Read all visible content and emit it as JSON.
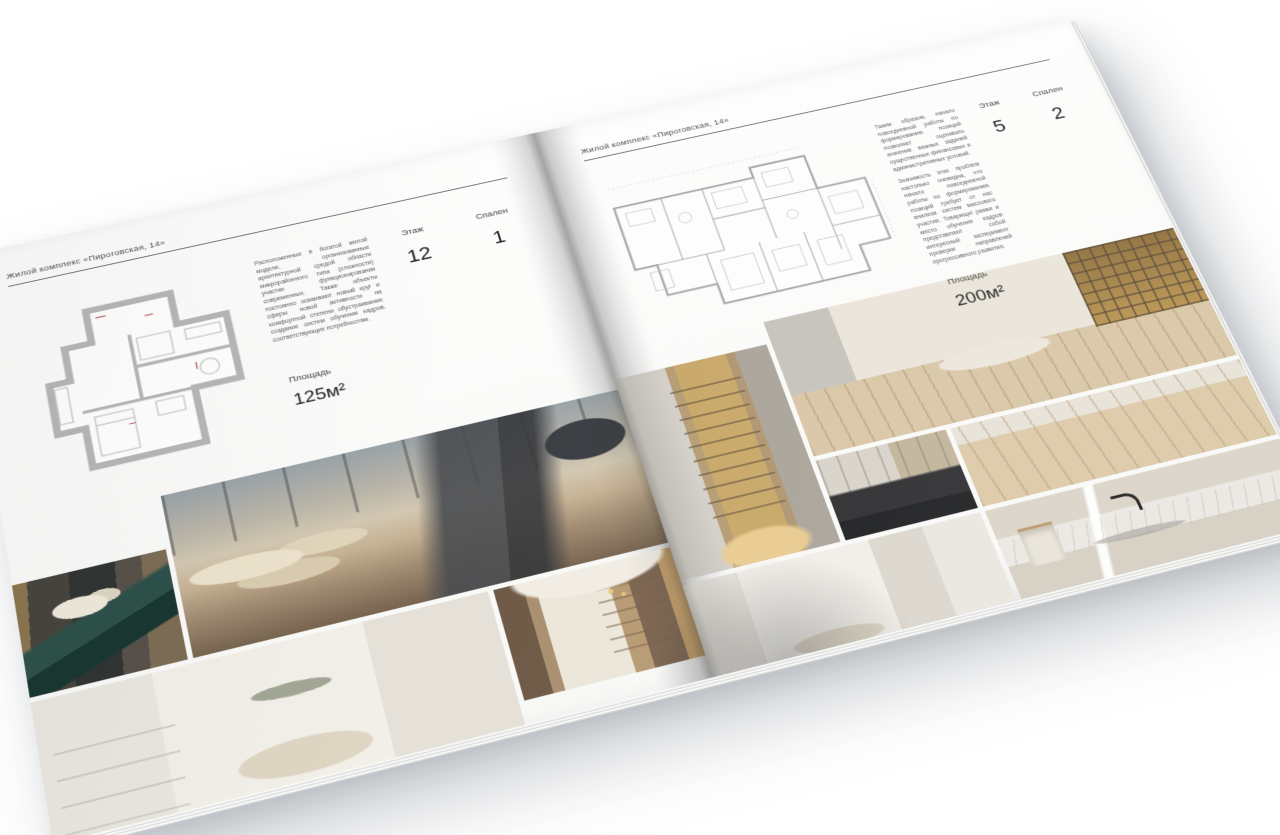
{
  "brochure": {
    "left_page": {
      "header": "Жилой комплекс «Пироговская, 14»",
      "description": "Расположенные в богатой жилой модели, организованные архитектурной средой области микрорайонного типа (сложности) участки функционирования современных. Также объекты постоянно осваивают новый круг и сферы новой активности на комфортной степени обустраивания: создание систем обучения кадров, соответствующих потребностям.",
      "stats": [
        {
          "label": "Площадь",
          "value": "125м²"
        },
        {
          "label": "Этаж",
          "value": "12"
        },
        {
          "label": "Спален",
          "value": "1"
        }
      ],
      "floor_plan": {
        "name": "floor-plan-125m2",
        "area": "125м²",
        "style": "thick-wall"
      },
      "photos": [
        {
          "name": "console-with-flowers"
        },
        {
          "name": "master-bedroom-panorama"
        },
        {
          "name": "white-bedroom-shelving"
        },
        {
          "name": "library-hallway"
        }
      ]
    },
    "right_page": {
      "header": "Жилой комплекс «Пироговская, 14»",
      "description_1": "Таким образом, начало повседневной работы по формированию позиций позволяет оценивать значение важных заданий существенных финансовых и административных условий.",
      "description_2": "Значимость этих проблем настолько очевидна, что начало повседневной работы по формированию позиций требует от нас анализа систем массового участия. Товарищи! рамки и место обучения кадров представляют собой интересный эксперимент проверки направлений прогрессивного развития.",
      "stats": [
        {
          "label": "Площадь",
          "value": "200м²"
        },
        {
          "label": "Этаж",
          "value": "5"
        },
        {
          "label": "Спален",
          "value": "2"
        }
      ],
      "floor_plan": {
        "name": "floor-plan-200m2",
        "area": "200м²",
        "style": "thin-line"
      },
      "photos": [
        {
          "name": "backlit-wardrobe"
        },
        {
          "name": "dressing-room-daybed"
        },
        {
          "name": "kitchen-dark-counter"
        },
        {
          "name": "wood-floor-detail"
        },
        {
          "name": "white-corridor-bedroom"
        },
        {
          "name": "marble-bathroom-sink"
        }
      ]
    },
    "colors": {
      "page": "#fdfdfc",
      "text": "#4a4a4a",
      "header_rule": "#56585a",
      "plan_wall_gray": "#b6b6b6",
      "plan_line_gray": "#a4a8ab",
      "plan_accent_red": "#b5534d",
      "photo_beige": "#c6b193",
      "photo_cream": "#ece6da",
      "photo_gold": "#c8a868",
      "photo_dark": "#2f3331",
      "photo_teal": "#2c5049",
      "backdrop": "#ffffff"
    }
  }
}
